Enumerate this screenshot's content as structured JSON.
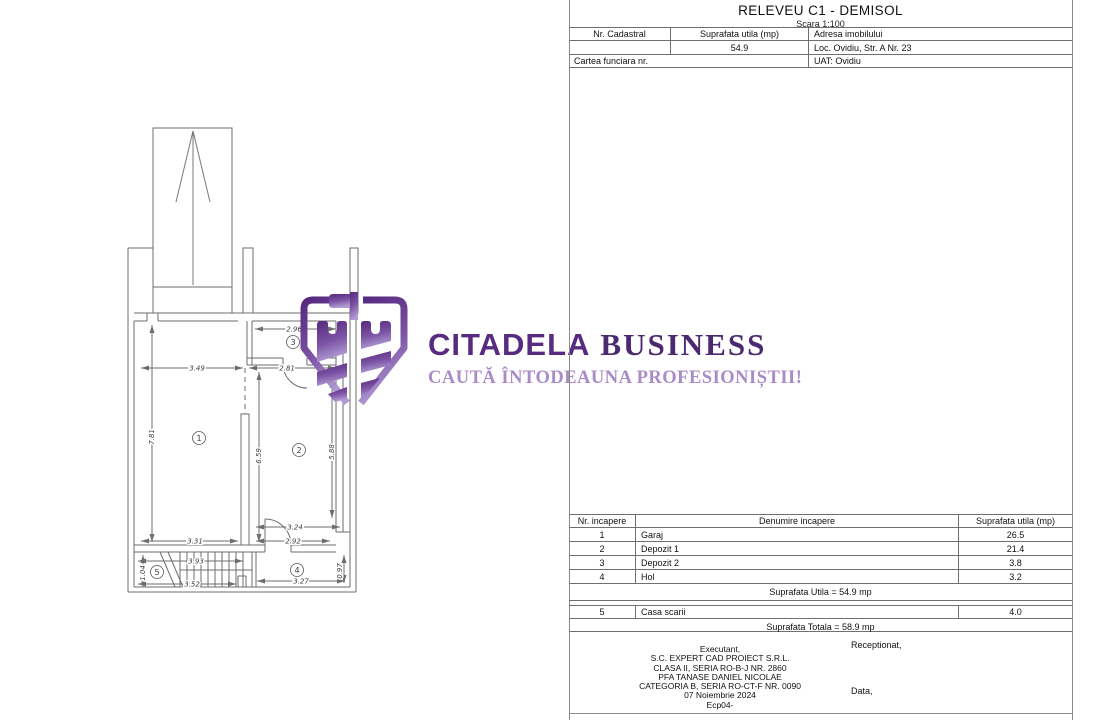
{
  "panel": {
    "title": "RELEVEU C1 - DEMISOL",
    "scale": "Scara 1:100",
    "info_table": {
      "col1_header": "Nr. Cadastral",
      "col2_header": "Suprafata utila (mp)",
      "col3_header": "Adresa imobilului",
      "col2_value": "54.9",
      "col3_value": "Loc. Ovidiu, Str. A Nr. 23",
      "row3_left": "Cartea funciara nr.",
      "row3_right": "UAT: Ovidiu"
    },
    "rooms_table": {
      "headers": [
        "Nr. incapere",
        "Denumire incapere",
        "Suprafata utila (mp)"
      ],
      "rows": [
        {
          "nr": "1",
          "name": "Garaj",
          "area": "26.5"
        },
        {
          "nr": "2",
          "name": "Depozit 1",
          "area": "21.4"
        },
        {
          "nr": "3",
          "name": "Depozit 2",
          "area": "3.8"
        },
        {
          "nr": "4",
          "name": "Hol",
          "area": "3.2"
        }
      ],
      "subtotal": "Suprafata Utila = 54.9 mp",
      "extra_row": {
        "nr": "5",
        "name": "Casa scarii",
        "area": "4.0"
      },
      "total": "Suprafata Totala = 58.9 mp"
    },
    "footer": {
      "executant_lines": [
        "Executant,",
        "S.C. EXPERT CAD PROIECT S.R.L.",
        "CLASA II, SERIA RO-B-J NR. 2860",
        "PFA TANASE DANIEL NICOLAE",
        "CATEGORIA B, SERIA RO-CT-F NR. 0090",
        "07 Noiembrie 2024",
        "Ecp04-"
      ],
      "receptionat": "Receptionat,",
      "data_label": "Data,"
    }
  },
  "watermark": {
    "brand_primary": "CITADELA",
    "brand_secondary": "BUSINESS",
    "tagline": "CAUTĂ ÎNTODEAUNA PROFESIONIȘTII!",
    "color_dark": "#572b80",
    "color_light": "#a98bc8"
  },
  "floorplan": {
    "rooms": [
      "1",
      "2",
      "3",
      "4",
      "5"
    ],
    "dims": {
      "d349": "3.49",
      "d281": "2.81",
      "d296": "2.96",
      "d781": "7.81",
      "d659": "6.59",
      "d588": "5.88",
      "d331": "3.31",
      "d324": "3.24",
      "d292": "2.92",
      "d393": "3.93",
      "d352": "3.52",
      "d104": "1.04",
      "d097": "0.97",
      "d327": "3.27"
    }
  }
}
